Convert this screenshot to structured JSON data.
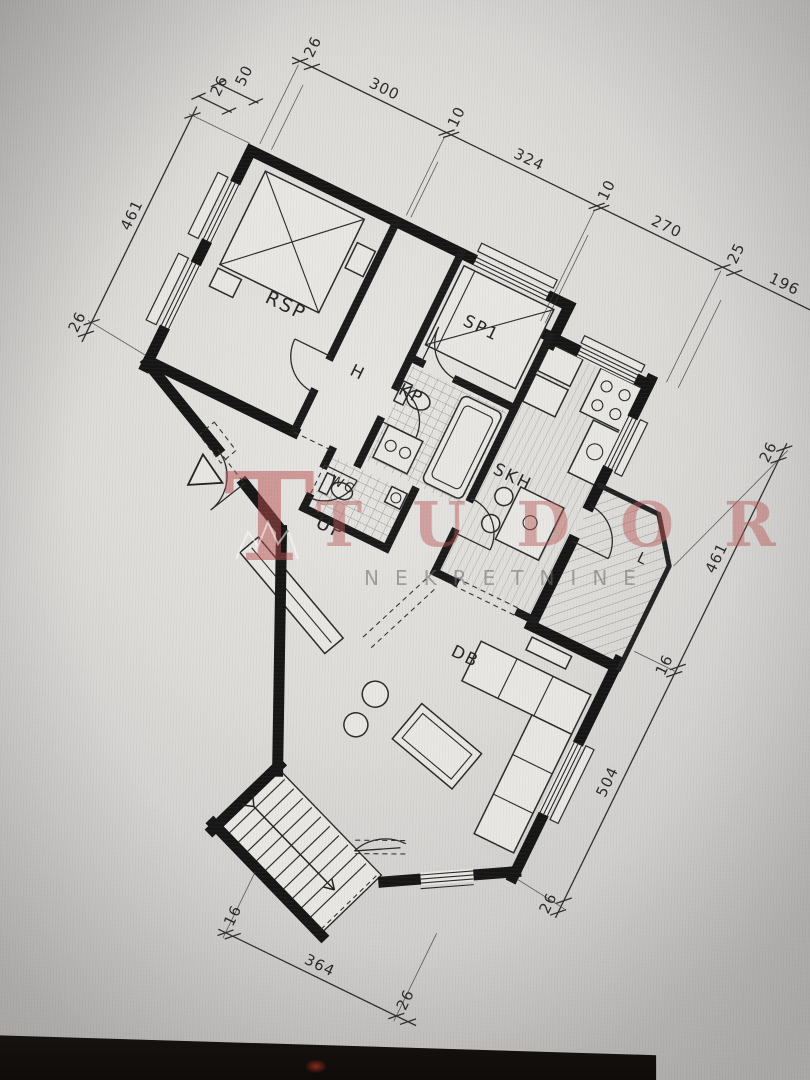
{
  "rooms": {
    "rsp": "RSP",
    "sp1": "SP1",
    "hall": "H",
    "bath": "KP",
    "wc": "WC",
    "kitchen": "SKH",
    "entry": "UP",
    "living": "DB",
    "loggia": "L"
  },
  "dimensions": {
    "top": [
      "26",
      "300",
      "10",
      "324",
      "10",
      "270",
      "25",
      "196"
    ],
    "top_left_pair": [
      "50",
      "26"
    ],
    "left": [
      "461",
      "26"
    ],
    "right": [
      "26",
      "461",
      "16",
      "504",
      "26"
    ],
    "bottom": [
      "16",
      "364",
      "26"
    ]
  },
  "watermark": {
    "logo_letter": "T",
    "brand": "TUDOR",
    "subtitle": "NEKRETNINE",
    "red": "#b85050",
    "gray": "#8c8c8c"
  },
  "colors": {
    "paper": "#e3e2df",
    "ink": "#1b1b1b",
    "bezel": "#15110e"
  }
}
